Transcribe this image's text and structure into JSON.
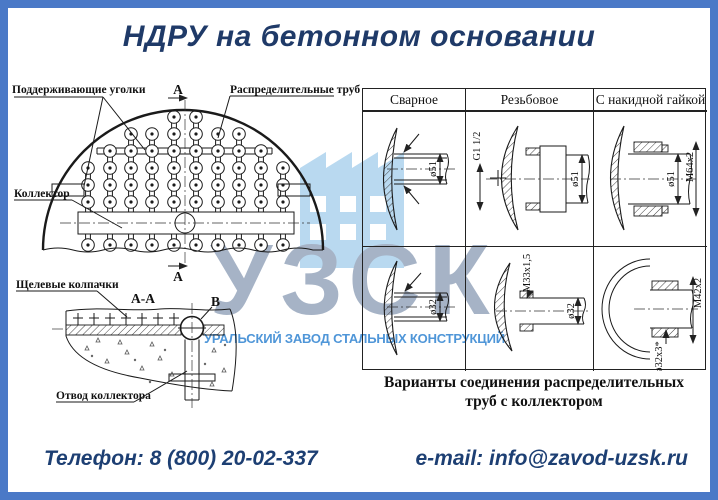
{
  "page": {
    "title": "НДРУ на бетонном основании"
  },
  "watermark": {
    "logo": "УЗСК",
    "company": "УРАЛЬСКИЙ ЗАВОД СТАЛЬНЫХ КОНСТРУКЦИЙ"
  },
  "scheme": {
    "labels": {
      "supporting_angles": "Поддерживающие уголки",
      "distribution_pipes": "Распределительные трубы",
      "collector": "Коллектор",
      "slot_caps": "Щелевые колпачки",
      "collector_outlet": "Отвод коллектора",
      "section_mark_top": "А",
      "section_mark_bottom": "А",
      "section_title": "А-А",
      "detail_mark": "В"
    }
  },
  "connections": {
    "headers": [
      "Сварное",
      "Резьбовое",
      "С накидной гайкой"
    ],
    "caption_line1": "Варианты соединения распределительных",
    "caption_line2": "труб с коллектором",
    "dims": {
      "welded1": "ø51",
      "threaded1_g": "G1 1/2",
      "threaded1_d": "ø51",
      "union1_d": "ø51",
      "union1_m": "М64х2",
      "welded2": "ø32",
      "threaded2_m": "М33х1,5",
      "threaded2_d": "ø32",
      "union2_m": "М42х2",
      "union2_d": "ø32х3*"
    }
  },
  "footer": {
    "phone": "Телефон: 8 (800) 20-02-337",
    "email": "e-mail: info@zavod-uzsk.ru"
  }
}
